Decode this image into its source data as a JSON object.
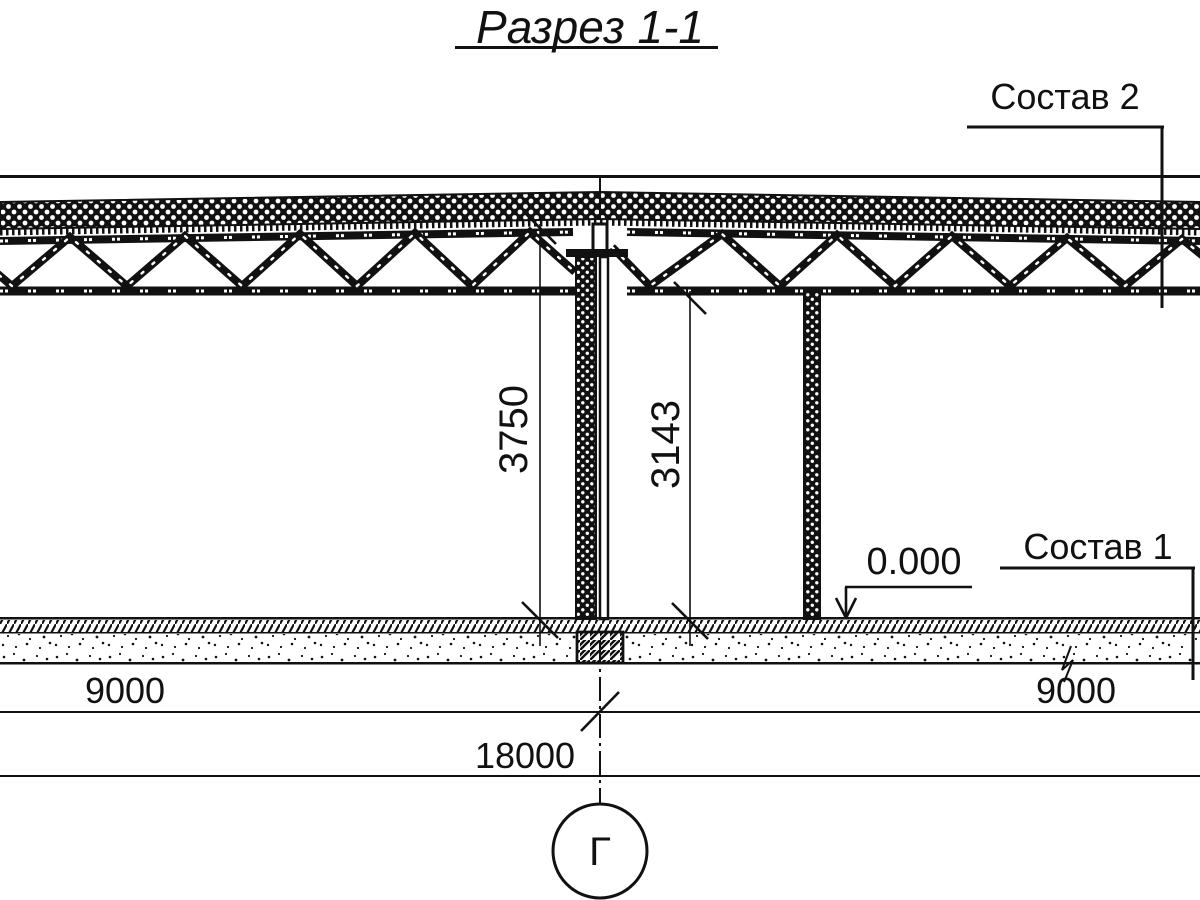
{
  "title": "Разрез 1-1",
  "labels": {
    "roof_composition": "Состав 2",
    "floor_composition": "Состав 1",
    "elevation_mark": "0.000"
  },
  "dimensions": {
    "floor_to_deck": "3750",
    "floor_to_chord": "3143",
    "span_left": "9000",
    "span_right": "9000",
    "span_total": "18000"
  },
  "axis": {
    "letter": "Г"
  },
  "colors": {
    "ink": "#111111",
    "background": "#ffffff"
  }
}
